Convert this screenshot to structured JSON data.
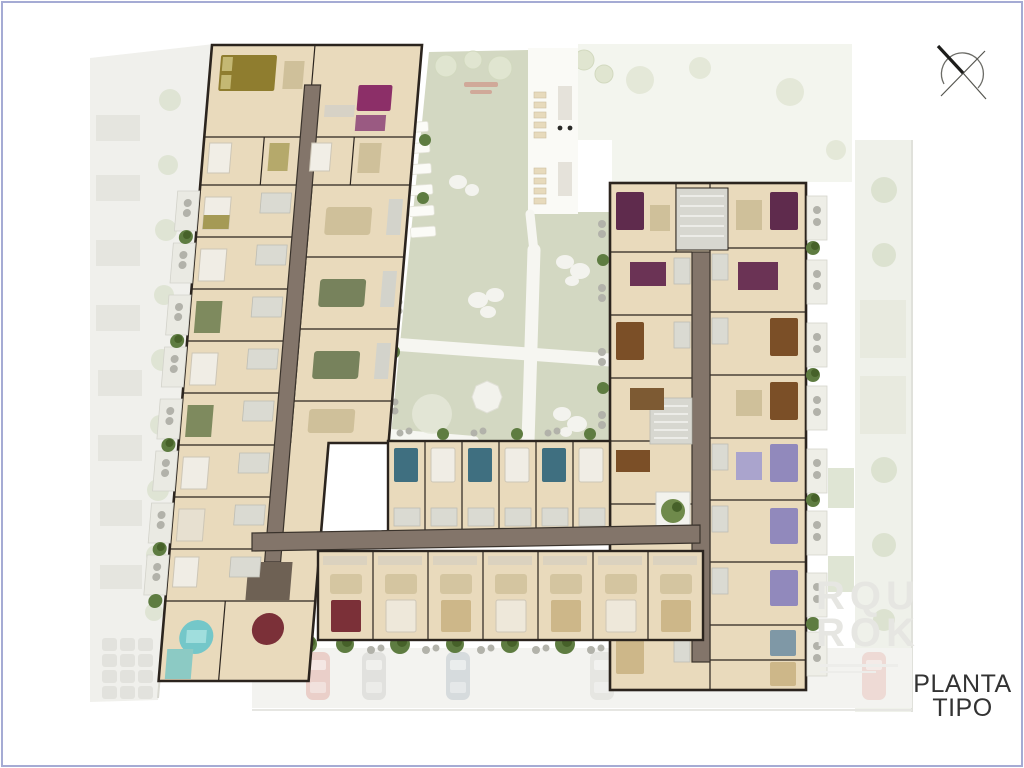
{
  "title": {
    "line1": "PLANTA",
    "line2": "TIPO"
  },
  "watermark": {
    "line1": "RQU",
    "line2": "ROK"
  },
  "icons": {
    "compass": "compass-north-arrow"
  },
  "palette": {
    "frame": "#a5abd4",
    "text": "#333333",
    "watermark": "#e6e6e2",
    "wall": "#2b241e",
    "floor": "#e9dabc",
    "floorLight": "#f0e6cf",
    "corridor": "#83756a",
    "corridorDark": "#3a332c",
    "lawn": "#d3d8c2",
    "lawnPale": "#e9ecdd",
    "path": "#f6f6f1",
    "deck": "#fafaf6",
    "context": "#f0f0ec",
    "contextEdge": "#d8d8d0",
    "gray": "#d7d7d0",
    "bush": "#5e7c41",
    "bushDark": "#466129",
    "olive": "#8f7d2f",
    "oliveLight": "#b5a96b",
    "magenta": "#8c2f68",
    "plum": "#5f2b4d",
    "lavender": "#9189bc",
    "teal": "#3f6f80",
    "tealLight": "#8ccac4",
    "blue": "#7f98a6",
    "brown": "#7b4f27",
    "tan": "#cdb789",
    "rugGreen": "#77825c",
    "rugTan": "#cfc09a",
    "maroon": "#7b3038",
    "turquoise": "#74c7c9",
    "chair": "#b2b2aa",
    "carPink": "#e8c3bd",
    "carGray": "#dcdcd8",
    "carBlue": "#cdd4d7",
    "red": "#cf8b7f"
  }
}
